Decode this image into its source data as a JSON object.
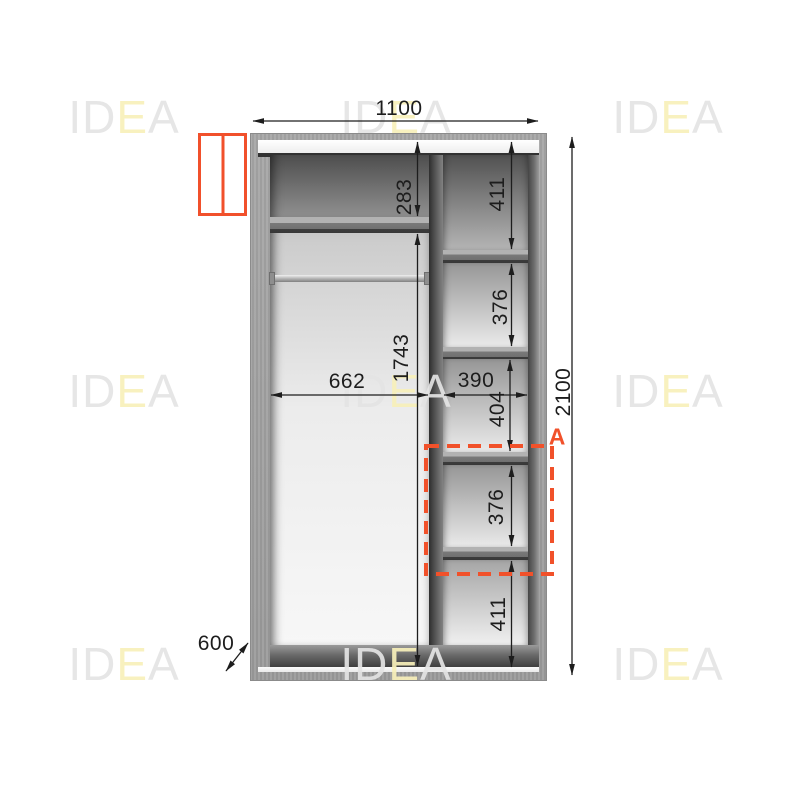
{
  "watermark": {
    "part_gray1": "ID",
    "part_yellow": "E",
    "part_gray2": "A"
  },
  "icons": {
    "door_schematic": "double-door-outline"
  },
  "colors": {
    "accent_orange": "#f1512a",
    "dimension_line": "#1d1d1d",
    "watermark_gray": "#e4e4e4",
    "watermark_yellow": "#f8f0ba"
  },
  "drawing": {
    "dimensions": {
      "overall_width": "1100",
      "overall_height": "2100",
      "depth": "600",
      "left_section_width": "662",
      "left_top_shelf_drop": "283",
      "left_section_height": "1743",
      "right_section_width": "390",
      "right_cells": [
        "411",
        "376",
        "404",
        "376",
        "411"
      ],
      "detail_label": "A"
    }
  }
}
